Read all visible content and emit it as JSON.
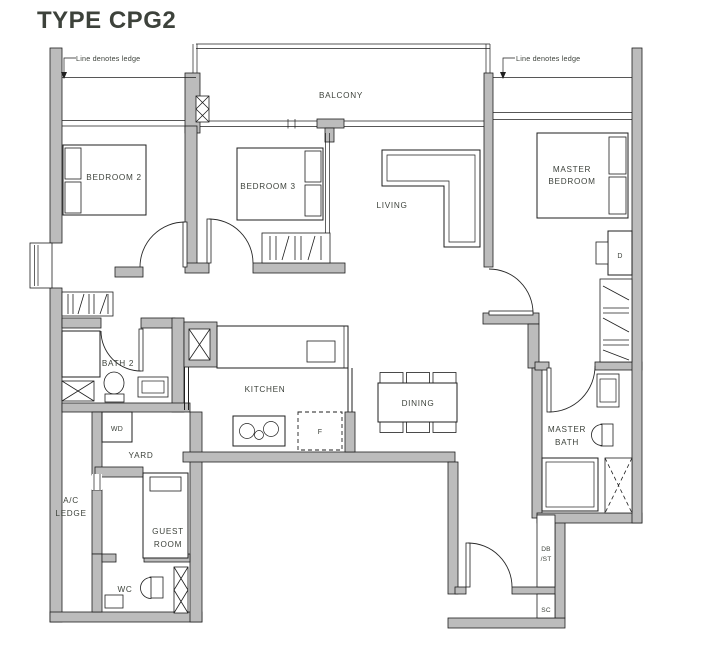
{
  "title": "TYPE CPG2",
  "annotations": {
    "ledge_left": "Line denotes ledge",
    "ledge_right": "Line denotes ledge"
  },
  "rooms": {
    "balcony": "BALCONY",
    "bedroom2": "BEDROOM 2",
    "bedroom3": "BEDROOM 3",
    "living": "LIVING",
    "master_bedroom_l1": "MASTER",
    "master_bedroom_l2": "BEDROOM",
    "bath2": "BATH 2",
    "kitchen": "KITCHEN",
    "dining": "DINING",
    "master_bath_l1": "MASTER",
    "master_bath_l2": "BATH",
    "yard": "YARD",
    "ac_ledge_l1": "A/C",
    "ac_ledge_l2": "LEDGE",
    "guest_room_l1": "GUEST",
    "guest_room_l2": "ROOM",
    "wc": "WC"
  },
  "fixtures": {
    "washer_dryer": "WD",
    "fridge": "F",
    "dresser": "D",
    "db": "DB",
    "st": "/ST",
    "shoe_cabinet": "SC"
  },
  "colors": {
    "title": "#2c3896",
    "label": "#3d423b",
    "wall_fill": "#bcbcbc",
    "line": "#1f1f1f"
  }
}
